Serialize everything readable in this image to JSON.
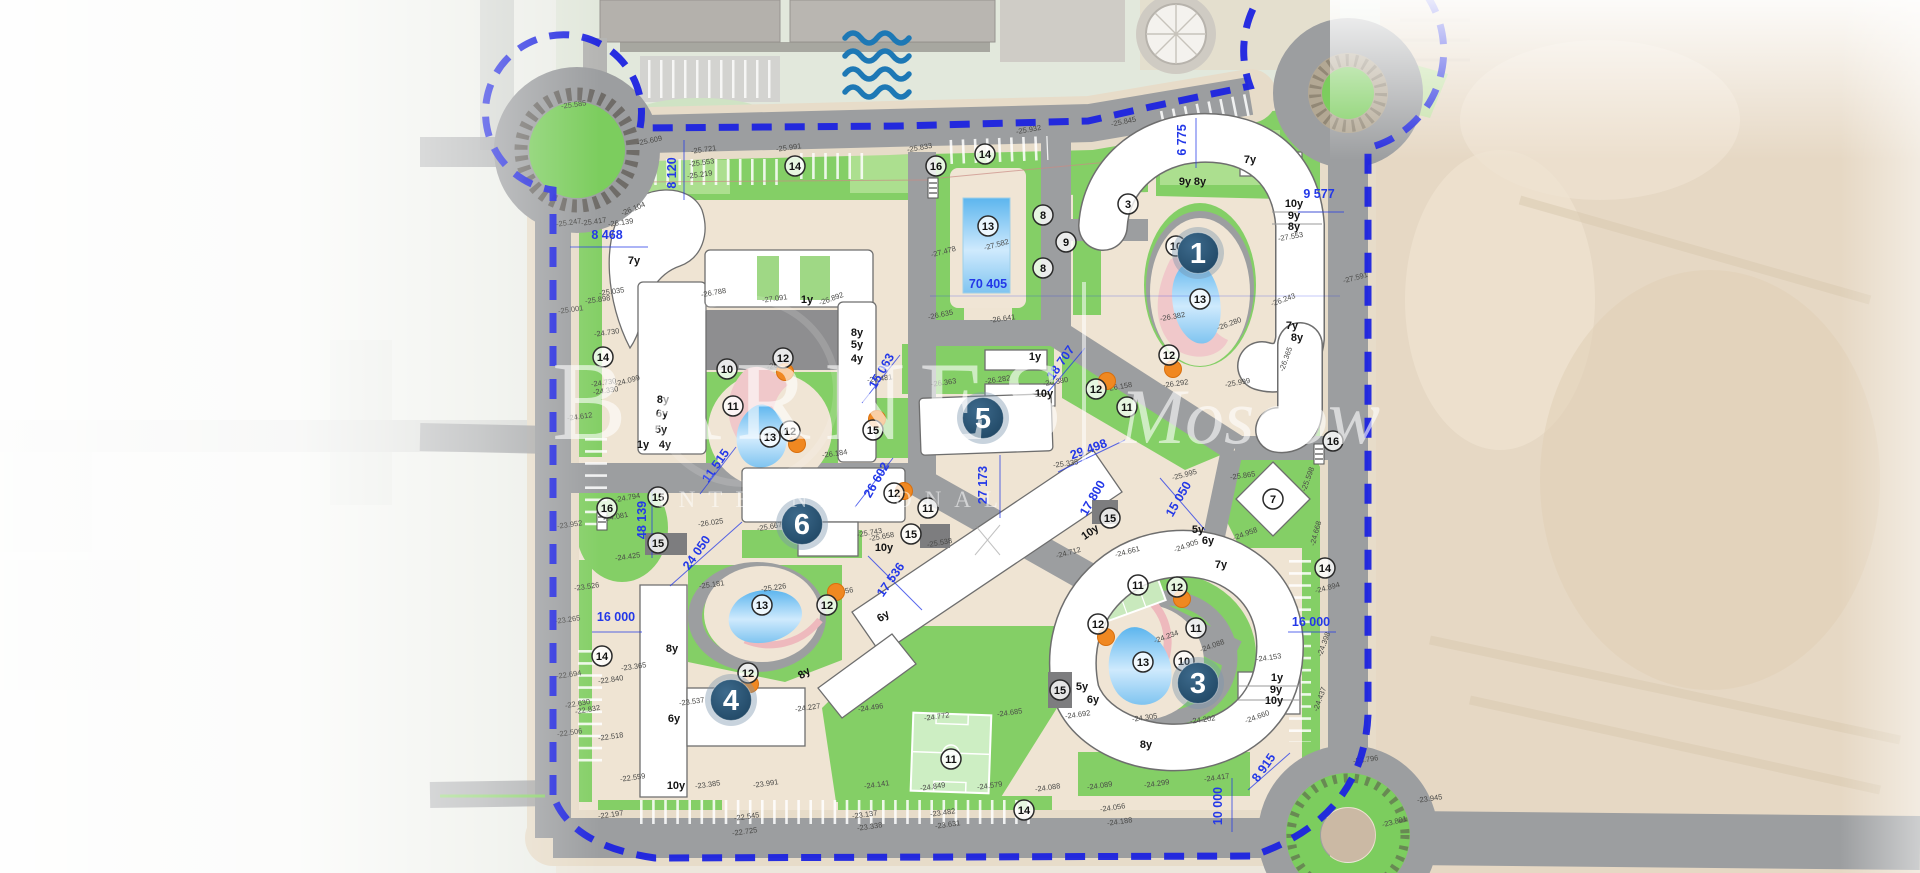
{
  "title": "Residential complex master plan",
  "watermark": {
    "brand": "BARNES",
    "international": "INTERNATIONAL",
    "separator": "|",
    "city": "Moscow"
  },
  "colors": {
    "boundary_blue": "#1c23e0",
    "dimension_blue": "#2338e8",
    "marker_navy_dark": "#1f4663",
    "marker_navy_light": "#3d6a8c",
    "tree_orange": "#f08821",
    "lawn_green": "#84cf66",
    "pool_blue": "#5cb5ee",
    "road_gray": "#9c9ea0",
    "pavement_beige": "#efe4d3",
    "pink_path": "#f0c8ca",
    "wave_blue": "#1d78b5"
  },
  "unit_markers": [
    {
      "n": "1",
      "x": 1198,
      "y": 253
    },
    {
      "n": "3",
      "x": 1198,
      "y": 683
    },
    {
      "n": "4",
      "x": 731,
      "y": 700
    },
    {
      "n": "5",
      "x": 983,
      "y": 418
    },
    {
      "n": "6",
      "x": 802,
      "y": 524
    }
  ],
  "dimension_labels": [
    {
      "t": "8 120",
      "x": 676,
      "y": 173,
      "r": -90
    },
    {
      "t": "8 468",
      "x": 607,
      "y": 239,
      "r": 0
    },
    {
      "t": "70 405",
      "x": 988,
      "y": 288,
      "r": 0,
      "s": 15
    },
    {
      "t": "9 577",
      "x": 1319,
      "y": 198,
      "r": 0
    },
    {
      "t": "6 775",
      "x": 1186,
      "y": 140,
      "r": -90
    },
    {
      "t": "18 707",
      "x": 1064,
      "y": 365,
      "r": -55
    },
    {
      "t": "15 063",
      "x": 885,
      "y": 373,
      "r": -60
    },
    {
      "t": "29 498",
      "x": 1090,
      "y": 453,
      "r": -20
    },
    {
      "t": "27 173",
      "x": 987,
      "y": 485,
      "r": -90
    },
    {
      "t": "26 602",
      "x": 880,
      "y": 482,
      "r": -60
    },
    {
      "t": "11 515",
      "x": 719,
      "y": 468,
      "r": -55
    },
    {
      "t": "48 139",
      "x": 646,
      "y": 520,
      "r": -90
    },
    {
      "t": "24 050",
      "x": 700,
      "y": 555,
      "r": -55
    },
    {
      "t": "16 000",
      "x": 616,
      "y": 621,
      "r": 0
    },
    {
      "t": "16 000",
      "x": 1311,
      "y": 626,
      "r": 0
    },
    {
      "t": "17 536",
      "x": 894,
      "y": 582,
      "r": -55
    },
    {
      "t": "15 050",
      "x": 1182,
      "y": 501,
      "r": -60
    },
    {
      "t": "17 800",
      "x": 1096,
      "y": 500,
      "r": -60
    },
    {
      "t": "10 000",
      "x": 1222,
      "y": 806,
      "r": -90
    },
    {
      "t": "8 915",
      "x": 1267,
      "y": 770,
      "r": -55
    }
  ],
  "amenity_circles": [
    {
      "n": "16",
      "x": 936,
      "y": 166
    },
    {
      "n": "16",
      "x": 607,
      "y": 508
    },
    {
      "n": "16",
      "x": 1333,
      "y": 441
    },
    {
      "n": "14",
      "x": 795,
      "y": 166
    },
    {
      "n": "14",
      "x": 985,
      "y": 154
    },
    {
      "n": "14",
      "x": 603,
      "y": 357
    },
    {
      "n": "14",
      "x": 602,
      "y": 656
    },
    {
      "n": "14",
      "x": 1325,
      "y": 568
    },
    {
      "n": "14",
      "x": 1024,
      "y": 810
    },
    {
      "n": "13",
      "x": 988,
      "y": 226
    },
    {
      "n": "13",
      "x": 1200,
      "y": 299
    },
    {
      "n": "13",
      "x": 770,
      "y": 437
    },
    {
      "n": "13",
      "x": 762,
      "y": 605
    },
    {
      "n": "13",
      "x": 1143,
      "y": 662
    },
    {
      "n": "8",
      "x": 1043,
      "y": 215
    },
    {
      "n": "8",
      "x": 1043,
      "y": 268
    },
    {
      "n": "9",
      "x": 1066,
      "y": 242
    },
    {
      "n": "3",
      "x": 1128,
      "y": 204
    },
    {
      "n": "10",
      "x": 727,
      "y": 369
    },
    {
      "n": "10",
      "x": 1176,
      "y": 246
    },
    {
      "n": "10",
      "x": 1184,
      "y": 661
    },
    {
      "n": "11",
      "x": 733,
      "y": 406
    },
    {
      "n": "11",
      "x": 928,
      "y": 508
    },
    {
      "n": "11",
      "x": 1127,
      "y": 407
    },
    {
      "n": "11",
      "x": 1138,
      "y": 585
    },
    {
      "n": "11",
      "x": 1196,
      "y": 628
    },
    {
      "n": "11",
      "x": 951,
      "y": 759
    },
    {
      "n": "12",
      "x": 783,
      "y": 358
    },
    {
      "n": "12",
      "x": 790,
      "y": 431
    },
    {
      "n": "12",
      "x": 894,
      "y": 493
    },
    {
      "n": "12",
      "x": 1096,
      "y": 389
    },
    {
      "n": "12",
      "x": 1169,
      "y": 355
    },
    {
      "n": "12",
      "x": 1177,
      "y": 587
    },
    {
      "n": "12",
      "x": 1098,
      "y": 624
    },
    {
      "n": "12",
      "x": 827,
      "y": 605
    },
    {
      "n": "12",
      "x": 748,
      "y": 673
    },
    {
      "n": "15",
      "x": 658,
      "y": 497
    },
    {
      "n": "15",
      "x": 658,
      "y": 543
    },
    {
      "n": "15",
      "x": 911,
      "y": 534
    },
    {
      "n": "15",
      "x": 873,
      "y": 430
    },
    {
      "n": "15",
      "x": 1110,
      "y": 518
    },
    {
      "n": "15",
      "x": 1060,
      "y": 690
    },
    {
      "n": "7",
      "x": 1273,
      "y": 499
    }
  ],
  "floor_labels": [
    {
      "t": "7y",
      "x": 634,
      "y": 264
    },
    {
      "t": "8y",
      "x": 663,
      "y": 403
    },
    {
      "t": "6y",
      "x": 662,
      "y": 417
    },
    {
      "t": "5y",
      "x": 661,
      "y": 433
    },
    {
      "t": "1y",
      "x": 643,
      "y": 448
    },
    {
      "t": "4y",
      "x": 665,
      "y": 448
    },
    {
      "t": "1y",
      "x": 807,
      "y": 303
    },
    {
      "t": "8y",
      "x": 857,
      "y": 336
    },
    {
      "t": "5y",
      "x": 857,
      "y": 348
    },
    {
      "t": "4y",
      "x": 857,
      "y": 362
    },
    {
      "t": "1y",
      "x": 1035,
      "y": 360
    },
    {
      "t": "10y",
      "x": 1044,
      "y": 397
    },
    {
      "t": "7y",
      "x": 1250,
      "y": 163
    },
    {
      "t": "9y",
      "x": 1185,
      "y": 185
    },
    {
      "t": "8y",
      "x": 1200,
      "y": 185
    },
    {
      "t": "10y",
      "x": 1294,
      "y": 207
    },
    {
      "t": "9y",
      "x": 1294,
      "y": 219
    },
    {
      "t": "8y",
      "x": 1294,
      "y": 230
    },
    {
      "t": "7y",
      "x": 1292,
      "y": 329
    },
    {
      "t": "8y",
      "x": 1297,
      "y": 341
    },
    {
      "t": "10y",
      "x": 884,
      "y": 551
    },
    {
      "t": "6y",
      "x": 885,
      "y": 619,
      "r": -33
    },
    {
      "t": "10y",
      "x": 1092,
      "y": 535,
      "r": -35
    },
    {
      "t": "8y",
      "x": 806,
      "y": 676,
      "r": -33
    },
    {
      "t": "8y",
      "x": 672,
      "y": 652
    },
    {
      "t": "6y",
      "x": 674,
      "y": 722
    },
    {
      "t": "10y",
      "x": 676,
      "y": 789
    },
    {
      "t": "5y",
      "x": 1082,
      "y": 690
    },
    {
      "t": "6y",
      "x": 1093,
      "y": 703
    },
    {
      "t": "8y",
      "x": 1146,
      "y": 748
    },
    {
      "t": "7y",
      "x": 1221,
      "y": 568
    },
    {
      "t": "5y",
      "x": 1198,
      "y": 533
    },
    {
      "t": "6y",
      "x": 1208,
      "y": 544
    },
    {
      "t": "1y",
      "x": 1277,
      "y": 681
    },
    {
      "t": "9y",
      "x": 1276,
      "y": 693
    },
    {
      "t": "10y",
      "x": 1274,
      "y": 704
    }
  ],
  "elevation_labels": [
    [
      "-25.585",
      574,
      107,
      -8
    ],
    [
      "-25.609",
      650,
      143,
      -12
    ],
    [
      "-25.721",
      704,
      152,
      -8
    ],
    [
      "-25.991",
      789,
      150,
      -8
    ],
    [
      "-25.553",
      702,
      165,
      -8
    ],
    [
      "-25.219",
      700,
      177,
      -8
    ],
    [
      "-25.833",
      920,
      150,
      -10
    ],
    [
      "-25.932",
      1029,
      132,
      -10
    ],
    [
      "-25.845",
      1124,
      124,
      -12
    ],
    [
      "-26.104",
      634,
      211,
      -22
    ],
    [
      "-25.247",
      569,
      225,
      -8
    ],
    [
      "-25.417",
      594,
      224,
      -8
    ],
    [
      "-26.139",
      621,
      225,
      -8
    ],
    [
      "-25.035",
      612,
      294,
      -8
    ],
    [
      "-25.898",
      598,
      302,
      -8
    ],
    [
      "-25.001",
      571,
      312,
      -8
    ],
    [
      "-24.730",
      607,
      335,
      -8
    ],
    [
      "-24.730",
      604,
      385,
      -8
    ],
    [
      "-24.330",
      606,
      393,
      -8
    ],
    [
      "-24.612",
      580,
      419,
      -8
    ],
    [
      "-24.099",
      628,
      383,
      -15
    ],
    [
      "-26.788",
      714,
      295,
      -10
    ],
    [
      "-27.091",
      775,
      301,
      -8
    ],
    [
      "-26.892",
      832,
      301,
      -20
    ],
    [
      "-26.748",
      780,
      367,
      -10
    ],
    [
      "-25.250",
      774,
      437,
      -10
    ],
    [
      "-26.184",
      835,
      456,
      -8
    ],
    [
      "-26.481",
      880,
      381,
      -8
    ],
    [
      "-26.363",
      944,
      385,
      -8
    ],
    [
      "-26.282",
      998,
      382,
      -8
    ],
    [
      "-27.478",
      944,
      254,
      -15
    ],
    [
      "-27.582",
      997,
      247,
      -15
    ],
    [
      "-26.635",
      941,
      317,
      -12
    ],
    [
      "-26.641",
      1003,
      321,
      -8
    ],
    [
      "-26.380",
      1056,
      384,
      -10
    ],
    [
      "-26.158",
      1120,
      389,
      -10
    ],
    [
      "-26.243",
      1284,
      302,
      -20
    ],
    [
      "-27.553",
      1291,
      239,
      -10
    ],
    [
      "-27.591",
      1356,
      280,
      -15
    ],
    [
      "-26.382",
      1173,
      319,
      -10
    ],
    [
      "-26.280",
      1230,
      326,
      -20
    ],
    [
      "-25.999",
      1238,
      385,
      -10
    ],
    [
      "-26.292",
      1176,
      386,
      -8
    ],
    [
      "-26.365",
      1288,
      360,
      -70
    ],
    [
      "-25.335",
      1066,
      466,
      -8
    ],
    [
      "-25.995",
      1185,
      477,
      -15
    ],
    [
      "-25.865",
      1243,
      478,
      -8
    ],
    [
      "-25.598",
      1310,
      480,
      -70
    ],
    [
      "-24.668",
      1318,
      534,
      -75
    ],
    [
      "-24.894",
      1328,
      590,
      -15
    ],
    [
      "-24.958",
      1246,
      536,
      -20
    ],
    [
      "-24.905",
      1187,
      548,
      -20
    ],
    [
      "-24.712",
      1069,
      555,
      -15
    ],
    [
      "-24.661",
      1128,
      554,
      -15
    ],
    [
      "-24.425",
      628,
      559,
      -8
    ],
    [
      "-23.952",
      570,
      527,
      -8
    ],
    [
      "-24.794",
      628,
      500,
      -10
    ],
    [
      "-24.081",
      616,
      519,
      -10
    ],
    [
      "-26.025",
      711,
      525,
      -8
    ],
    [
      "-25.667",
      770,
      529,
      -10
    ],
    [
      "-25.743",
      870,
      535,
      -10
    ],
    [
      "-25.658",
      882,
      539,
      -10
    ],
    [
      "-25.538",
      940,
      545,
      -10
    ],
    [
      "-25.181",
      712,
      587,
      -8
    ],
    [
      "-25.226",
      774,
      590,
      -8
    ],
    [
      "-25.056",
      841,
      594,
      -8
    ],
    [
      "-23.526",
      587,
      589,
      -8
    ],
    [
      "-23.265",
      568,
      622,
      -8
    ],
    [
      "-23.365",
      634,
      669,
      -8
    ],
    [
      "-22.694",
      569,
      677,
      -8
    ],
    [
      "-22.840",
      611,
      682,
      -8
    ],
    [
      "-22.832",
      588,
      712,
      -10
    ],
    [
      "-22.630",
      578,
      706,
      -10
    ],
    [
      "-22.506",
      570,
      735,
      -8
    ],
    [
      "-22.518",
      611,
      739,
      -8
    ],
    [
      "-22.559",
      633,
      780,
      -8
    ],
    [
      "-22.197",
      611,
      817,
      -8
    ],
    [
      "-23.537",
      692,
      704,
      -8
    ],
    [
      "-23.385",
      708,
      787,
      -8
    ],
    [
      "-23.991",
      766,
      786,
      -8
    ],
    [
      "-22.545",
      747,
      819,
      -8
    ],
    [
      "-22.725",
      745,
      834,
      -8
    ],
    [
      "-24.227",
      808,
      710,
      -8
    ],
    [
      "-24.496",
      871,
      710,
      -8
    ],
    [
      "-24.772",
      937,
      719,
      -8
    ],
    [
      "-24.685",
      1010,
      715,
      -8
    ],
    [
      "-24.141",
      877,
      787,
      -8
    ],
    [
      "-24.849",
      933,
      789,
      -8
    ],
    [
      "-24.579",
      990,
      788,
      -8
    ],
    [
      "-24.088",
      1048,
      790,
      -8
    ],
    [
      "-24.089",
      1100,
      788,
      -8
    ],
    [
      "-23.137",
      865,
      817,
      -8
    ],
    [
      "-23.482",
      943,
      815,
      -8
    ],
    [
      "-23.631",
      948,
      827,
      -8
    ],
    [
      "-23.338",
      870,
      829,
      -8
    ],
    [
      "-24.056",
      1113,
      810,
      -8
    ],
    [
      "-24.188",
      1120,
      824,
      -8
    ],
    [
      "-24.299",
      1157,
      786,
      -8
    ],
    [
      "-24.417",
      1217,
      780,
      -8
    ],
    [
      "-24.234",
      1167,
      639,
      -20
    ],
    [
      "-24.088",
      1213,
      648,
      -20
    ],
    [
      "-24.153",
      1269,
      660,
      -8
    ],
    [
      "-24.660",
      1258,
      719,
      -20
    ],
    [
      "-24.692",
      1078,
      717,
      -8
    ],
    [
      "-24.305",
      1145,
      720,
      -8
    ],
    [
      "-24.202",
      1203,
      722,
      -8
    ],
    [
      "-24.398",
      1326,
      645,
      -70
    ],
    [
      "-24.437",
      1322,
      700,
      -70
    ],
    [
      "-23.796",
      1366,
      762,
      -8
    ],
    [
      "-23.945",
      1430,
      801,
      -8
    ],
    [
      "-23.801",
      1395,
      824,
      -15
    ]
  ],
  "tree_markers": [
    [
      785,
      372
    ],
    [
      797,
      444
    ],
    [
      877,
      419
    ],
    [
      904,
      491
    ],
    [
      836,
      592
    ],
    [
      750,
      684
    ],
    [
      1107,
      381
    ],
    [
      1173,
      369
    ],
    [
      1182,
      599
    ],
    [
      1106,
      637
    ]
  ]
}
